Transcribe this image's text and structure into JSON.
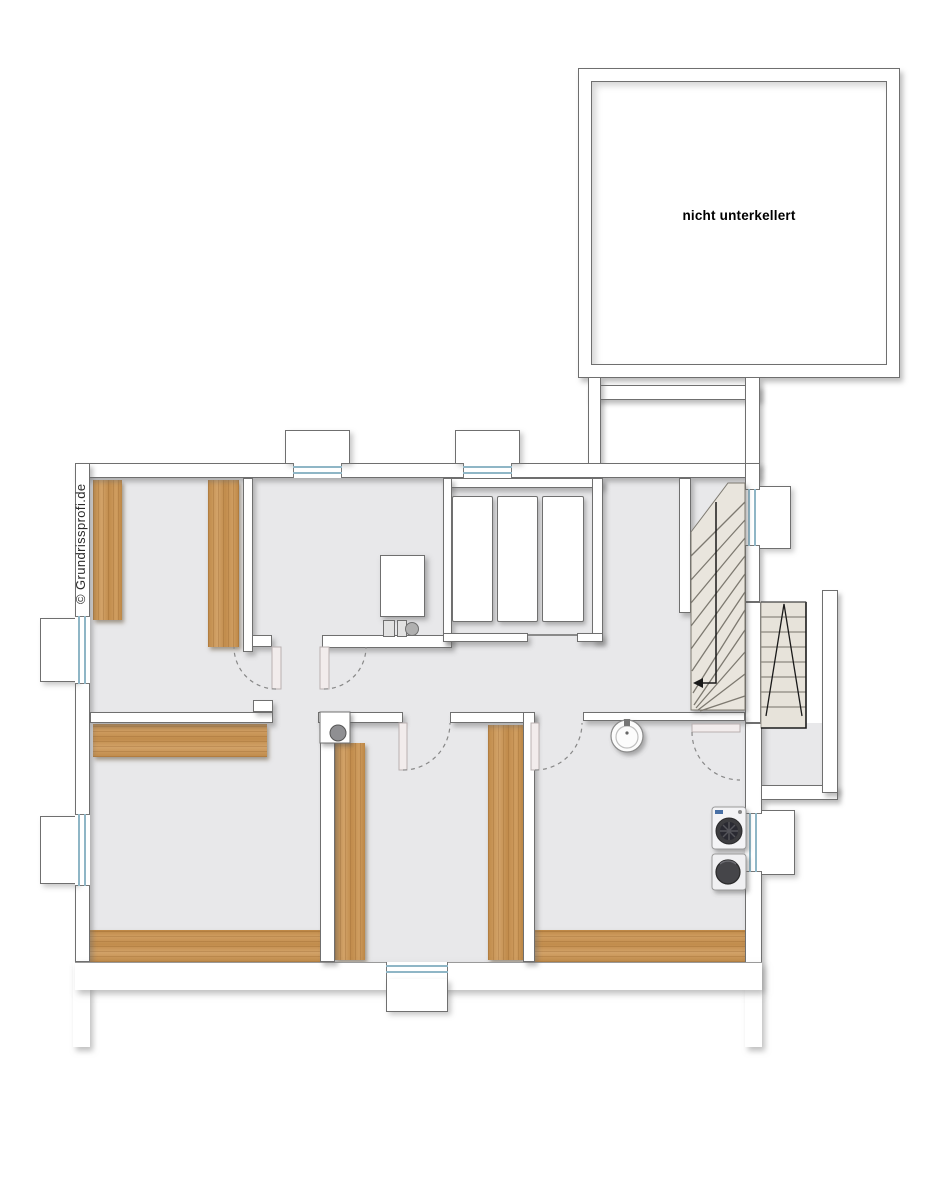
{
  "canvas": {
    "width_px": 946,
    "height_px": 1200,
    "background": "#ffffff"
  },
  "texts": {
    "not_cellared_label": "nicht unterkellert",
    "watermark": "© Grundrissprofi.de"
  },
  "palette": {
    "floor_gray": "#e8e8ea",
    "wall_white": "#ffffff",
    "wall_outline": "#6f6f6f",
    "wood_panel": "#c79455",
    "window_glazing_blue": "#8fb6c6",
    "stair_tread_beige": "#e9e5dd",
    "appliance_drum_dark": "#3c3c40",
    "annotation_black": "#1a1a1a",
    "door_swing_dash_gray": "#888888"
  },
  "plan": {
    "type": "basement-floor-plan",
    "not_cellared_area": 1,
    "doors_with_swing_arcs": 5,
    "windows_with_light_wells": 7,
    "wood_panels": 7,
    "fixtures": [
      "boiler",
      "heating-unit-with-pump",
      "oil-tank-1",
      "oil-tank-2",
      "oil-tank-3",
      "chimney-block",
      "wash-basin",
      "washing-machine",
      "tumble-dryer",
      "winder-staircase",
      "exterior-staircase"
    ]
  }
}
